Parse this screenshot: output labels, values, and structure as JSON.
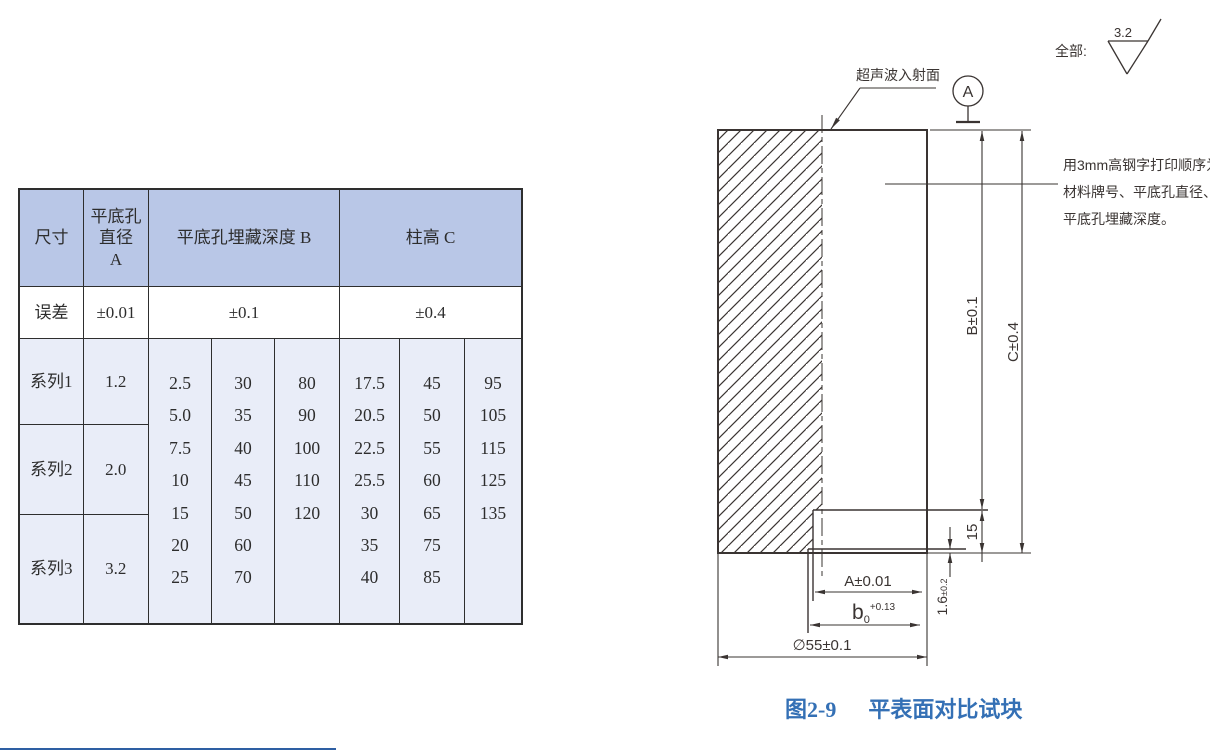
{
  "table": {
    "header": {
      "col_size": "尺寸",
      "col_a": "平底孔\n直径\nA",
      "col_b": "平底孔埋藏深度 B",
      "col_c": "柱高 C"
    },
    "tolerance": {
      "label": "误差",
      "a": "±0.01",
      "b": "±0.1",
      "c": "±0.4"
    },
    "series": [
      {
        "label": "系列1",
        "a": "1.2"
      },
      {
        "label": "系列2",
        "a": "2.0"
      },
      {
        "label": "系列3",
        "a": "3.2"
      }
    ],
    "b_columns": [
      [
        "2.5",
        "5.0",
        "7.5",
        "10",
        "15",
        "20",
        "25"
      ],
      [
        "30",
        "35",
        "40",
        "45",
        "50",
        "60",
        "70"
      ],
      [
        "80",
        "90",
        "100",
        "110",
        "120"
      ]
    ],
    "c_columns": [
      [
        "17.5",
        "20.5",
        "22.5",
        "25.5",
        "30",
        "35",
        "40"
      ],
      [
        "45",
        "50",
        "55",
        "60",
        "65",
        "75",
        "85"
      ],
      [
        "95",
        "105",
        "115",
        "125",
        "135"
      ]
    ]
  },
  "drawing": {
    "surface_note": "全部:",
    "roughness_value": "3.2",
    "datum_label": "A",
    "incident_label": "超声波入射面",
    "print_note_lines": [
      "用3mm高钢字打印顺序为:",
      "材料牌号、平底孔直径、",
      "平底孔埋藏深度。"
    ],
    "dims": {
      "hole_dia": "A±0.01",
      "bore_base": "b",
      "bore_sub": "0",
      "bore_sup": "+0.13",
      "outer_dia": "∅55±0.1",
      "depth_b": "B±0.1",
      "height_c": "C±0.4",
      "bore_depth": "15",
      "membrane": "1.6",
      "membrane_tol": "±0.2"
    }
  },
  "caption": {
    "number": "图2-9",
    "title": "平表面对比试块"
  },
  "colors": {
    "header_fill": "#b9c7e7",
    "body_fill": "#e9edf8",
    "line": "#3a3432",
    "caption_blue": "#3470b5"
  }
}
